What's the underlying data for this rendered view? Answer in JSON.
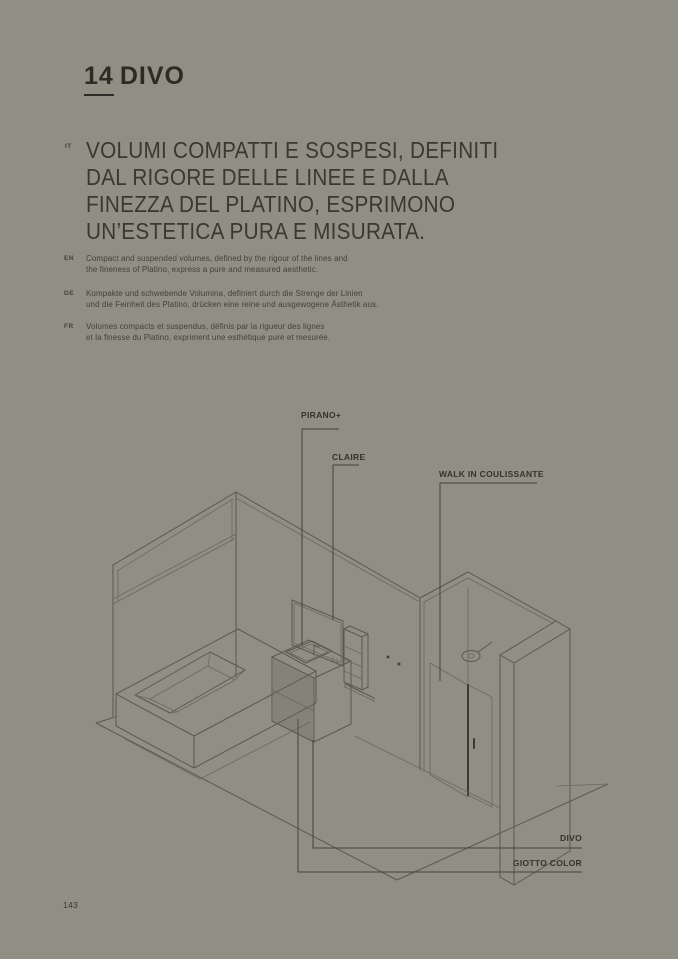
{
  "page": {
    "number": "143"
  },
  "header": {
    "chapter_number": "14",
    "chapter_name": "DIVO"
  },
  "headline": {
    "lang": "IT",
    "lines": [
      "VOLUMI COMPATTI E SOSPESI, DEFINITI",
      "DAL RIGORE DELLE LINEE E DALLA",
      "FINEZZA DEL PLATINO, ESPRIMONO",
      "UN’ESTETICA PURA E MISURATA."
    ]
  },
  "descriptions": [
    {
      "lang": "EN",
      "line1": "Compact and suspended volumes, defined by the rigour of the lines and",
      "line2": "the fineness of Platino, express a pure and measured aesthetic."
    },
    {
      "lang": "DE",
      "line1": "Kompakte und schwebende Volumina, definiert durch die Strenge der Linien",
      "line2": "und die Feinheit des Platino, drücken eine reine und ausgewogene Ästhetik aus."
    },
    {
      "lang": "FR",
      "line1": "Volumes compacts et suspendus, définis par la rigueur des lignes",
      "line2": "et la finesse du Platino, expriment une esthétique pure et mesurée."
    }
  ],
  "diagram": {
    "labels": [
      {
        "id": "pirano",
        "text": "PIRANO+"
      },
      {
        "id": "claire",
        "text": "CLAIRE"
      },
      {
        "id": "walkin",
        "text": "WALK IN COULISSANTE"
      },
      {
        "id": "divo",
        "text": "DIVO"
      },
      {
        "id": "giotto",
        "text": "GIOTTO COLOR"
      }
    ]
  },
  "colors": {
    "background": "#918e84",
    "line": "#5c594f",
    "text_dark": "#2d2b26"
  }
}
